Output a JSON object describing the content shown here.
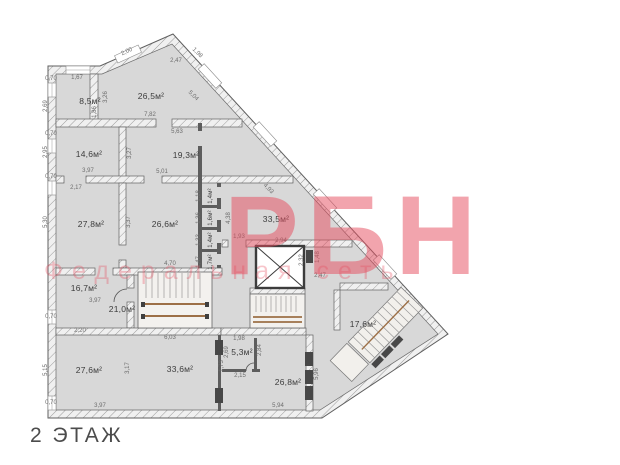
{
  "title": "2 ЭТАЖ",
  "watermark": {
    "brand": "РБН",
    "tagline": "Федеральная сеть",
    "color": "#e64a5c"
  },
  "plan_colors": {
    "room_fill": "#d8d8d8",
    "wall_line": "#5f5f5f",
    "stair_rail": "#9c6f46"
  },
  "rooms": [
    {
      "name": "room-top-left",
      "area": "8,5м²"
    },
    {
      "name": "room-top-triangle",
      "area": "26,5м²"
    },
    {
      "name": "room-left-2",
      "area": "14,6м²"
    },
    {
      "name": "room-mid-2",
      "area": "19,3м²"
    },
    {
      "name": "room-left-3",
      "area": "27,8м²"
    },
    {
      "name": "room-mid-3",
      "area": "26,6м²"
    },
    {
      "name": "room-right-triangle",
      "area": "33,5м²"
    },
    {
      "name": "closet-1",
      "area": "1,4м²"
    },
    {
      "name": "closet-2",
      "area": "1,6м²"
    },
    {
      "name": "closet-3",
      "area": "1,4м²"
    },
    {
      "name": "closet-4",
      "area": "1,7м²"
    },
    {
      "name": "room-left-4",
      "area": "16,7м²"
    },
    {
      "name": "corridor",
      "area": "21,0м²"
    },
    {
      "name": "room-bottom-left",
      "area": "27,6м²"
    },
    {
      "name": "room-bottom-mid",
      "area": "33,6м²"
    },
    {
      "name": "room-small-bottom",
      "area": "5,3м²"
    },
    {
      "name": "room-bottom-right",
      "area": "26,8м²"
    },
    {
      "name": "room-diagonal",
      "area": "17,6м²"
    }
  ],
  "dims": [
    "2,00",
    "2,47",
    "1,98",
    "5,04",
    "0,70",
    "1,67",
    "2,69",
    "1,86",
    "3,26",
    "7,82",
    "5,63",
    "3,27",
    "2,95",
    "3,97",
    "5,01",
    "2,17",
    "5,30",
    "3,37",
    "4,70",
    "4,38",
    "1,93",
    "4,93",
    "2,94",
    "2,32",
    "1,48",
    "2,47",
    "0,70",
    "0,70",
    "0,70",
    "0,70",
    "3,97",
    "2,20",
    "6,03",
    "5,15",
    "3,17",
    "3,97",
    "1,73",
    "1,98",
    "2,69",
    "2,15",
    "2,84",
    "5,94",
    "5,96",
    "1,18",
    "1,36",
    "1,33",
    "1,47"
  ]
}
